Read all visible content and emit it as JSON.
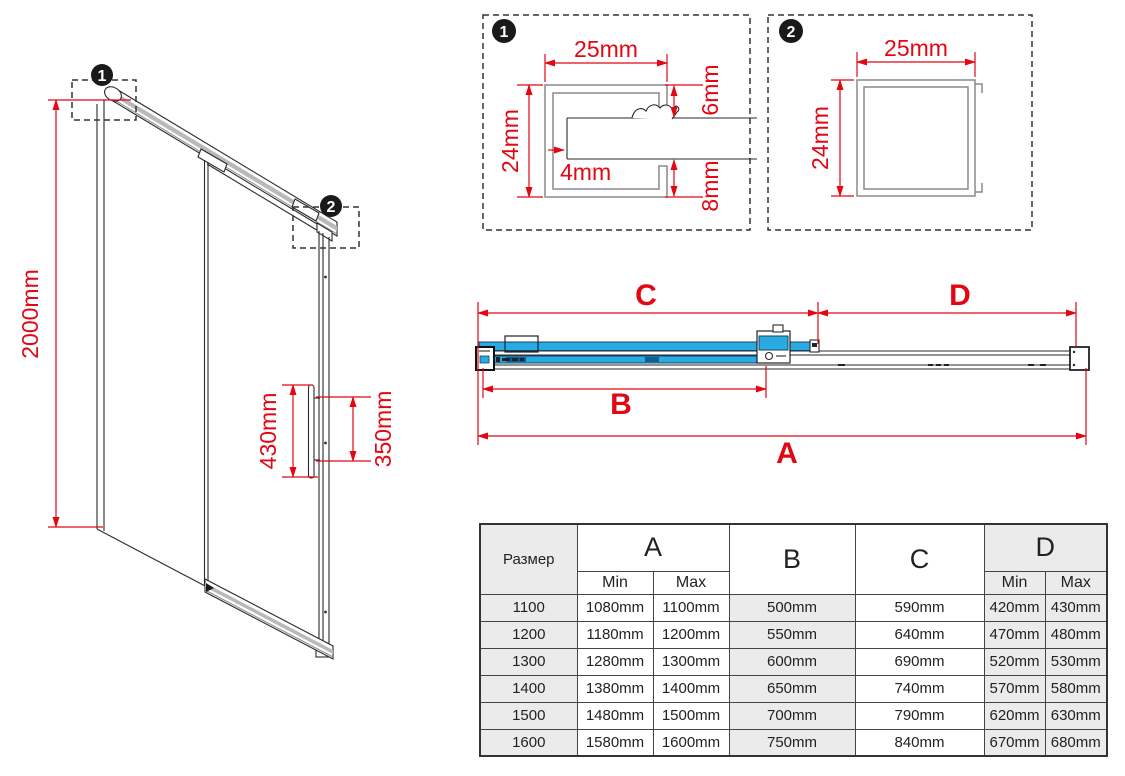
{
  "palette": {
    "accent_red": "#e30613",
    "glass_blue": "#29abe2",
    "line": "#2a2a2a"
  },
  "iso_view": {
    "height_dim": "2000mm",
    "handle_dim": "430mm",
    "handle_holes_dim": "350mm",
    "callout_1": "1",
    "callout_2": "2"
  },
  "detail_1": {
    "callout": "1",
    "width_dim": "25mm",
    "height_dim": "24mm",
    "top_inset_dim": "6mm",
    "glass_slot_dim": "4mm",
    "bottom_inset_dim": "8mm"
  },
  "detail_2": {
    "callout": "2",
    "width_dim": "25mm",
    "height_dim": "24mm"
  },
  "plan_view": {
    "dim_a": "A",
    "dim_b": "B",
    "dim_c": "C",
    "dim_d": "D"
  },
  "size_table": {
    "size_col_header": "Размер",
    "col_a": "A",
    "col_b": "B",
    "col_c": "C",
    "col_d": "D",
    "min_label": "Min",
    "max_label": "Max",
    "rows": [
      {
        "size": "1100",
        "a_min": "1080mm",
        "a_max": "1100mm",
        "b": "500mm",
        "c": "590mm",
        "d_min": "420mm",
        "d_max": "430mm"
      },
      {
        "size": "1200",
        "a_min": "1180mm",
        "a_max": "1200mm",
        "b": "550mm",
        "c": "640mm",
        "d_min": "470mm",
        "d_max": "480mm"
      },
      {
        "size": "1300",
        "a_min": "1280mm",
        "a_max": "1300mm",
        "b": "600mm",
        "c": "690mm",
        "d_min": "520mm",
        "d_max": "530mm"
      },
      {
        "size": "1400",
        "a_min": "1380mm",
        "a_max": "1400mm",
        "b": "650mm",
        "c": "740mm",
        "d_min": "570mm",
        "d_max": "580mm"
      },
      {
        "size": "1500",
        "a_min": "1480mm",
        "a_max": "1500mm",
        "b": "700mm",
        "c": "790mm",
        "d_min": "620mm",
        "d_max": "630mm"
      },
      {
        "size": "1600",
        "a_min": "1580mm",
        "a_max": "1600mm",
        "b": "750mm",
        "c": "840mm",
        "d_min": "670mm",
        "d_max": "680mm"
      }
    ]
  }
}
